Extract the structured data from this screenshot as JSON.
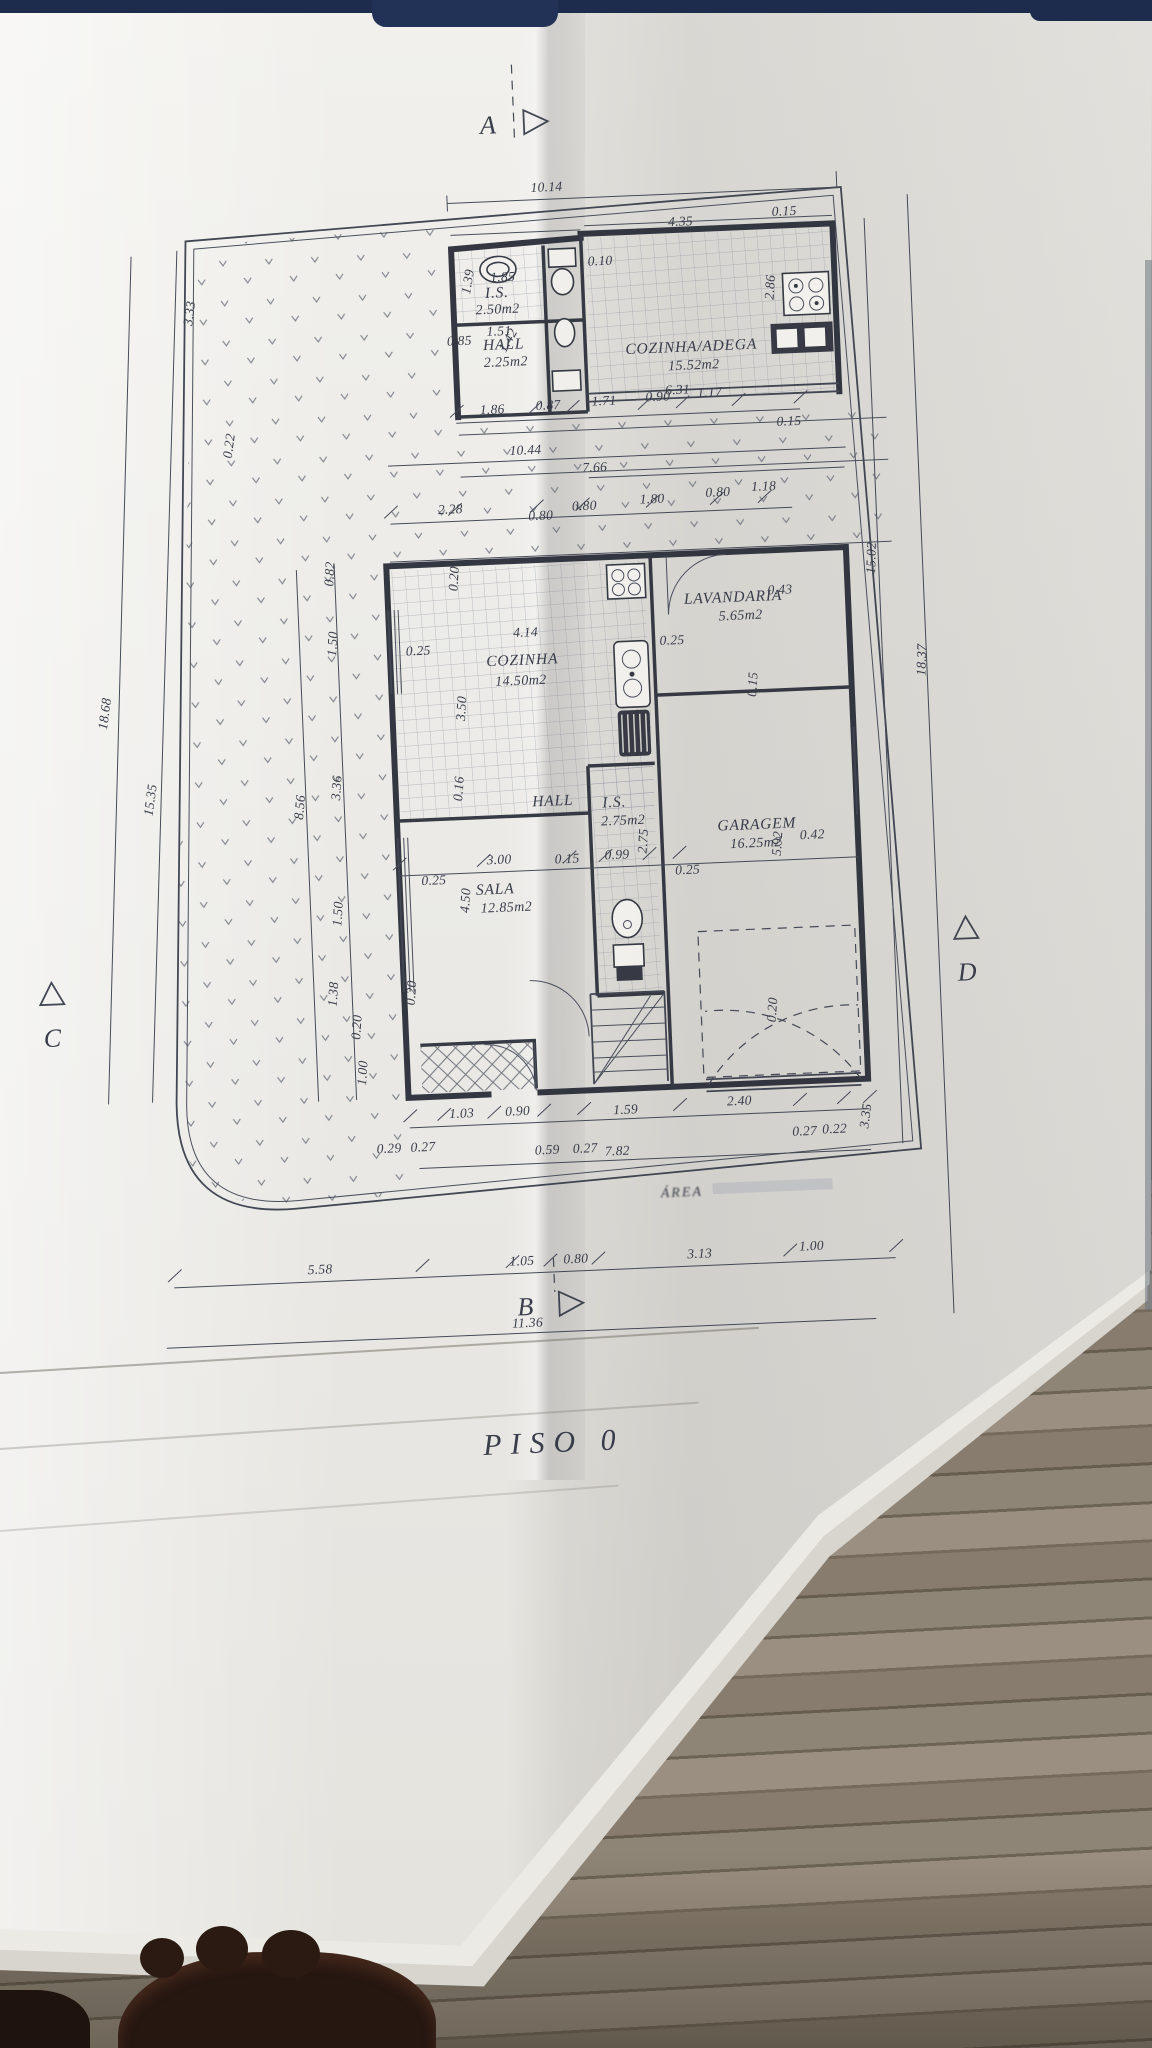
{
  "markers": {
    "section_a": "A",
    "section_b": "B",
    "section_c": "C",
    "section_d": "D"
  },
  "title": {
    "floor_label": "PISO  0"
  },
  "faint_note": "ÁREA",
  "rooms": [
    {
      "label": "I.S.",
      "area": "2.50m2"
    },
    {
      "label": "HALL",
      "area": "2.25m2"
    },
    {
      "label": "COZINHA/ADEGA",
      "area": "15.52m2"
    },
    {
      "label": "COZINHA",
      "area": "14.50m2"
    },
    {
      "label": "LAVANDARIA",
      "area": "5.65m2"
    },
    {
      "label": "HALL",
      "area": ""
    },
    {
      "label": "I.S.",
      "area": "2.75m2"
    },
    {
      "label": "SALA",
      "area": "12.85m2"
    },
    {
      "label": "GARAGEM",
      "area": "16.25m2"
    }
  ],
  "dims": [
    "10.14",
    "1.85",
    "1.39",
    "1.51",
    "0.85",
    "1.42",
    "0.10",
    "4.35",
    "0.15",
    "2.86",
    "6.31",
    "1.86",
    "0.87",
    "1.71",
    "0.90",
    "1.17",
    "0.15",
    "10.44",
    "7.66",
    "2.28",
    "0.80",
    "0.80",
    "1.80",
    "0.80",
    "1.18",
    "0.82",
    "0.20",
    "1.50",
    "0.25",
    "4.14",
    "3.50",
    "0.25",
    "0.43",
    "0.15",
    "0.16",
    "3.00",
    "0.15",
    "0.99",
    "2.75",
    "0.25",
    "4.50",
    "5.92",
    "0.42",
    "0.25",
    "0.20",
    "0.20",
    "1.03",
    "0.90",
    "1.59",
    "2.40",
    "0.29",
    "0.27",
    "0.59",
    "0.27",
    "7.82",
    "0.27",
    "0.22",
    "3.35",
    "5.58",
    "1.05",
    "0.80",
    "3.13",
    "1.00",
    "11.36",
    "3.33",
    "0.22",
    "18.68",
    "15.35",
    "8.56",
    "3.36",
    "1.50",
    "1.38",
    "1.00",
    "15.02",
    "18.37",
    "0.20"
  ]
}
